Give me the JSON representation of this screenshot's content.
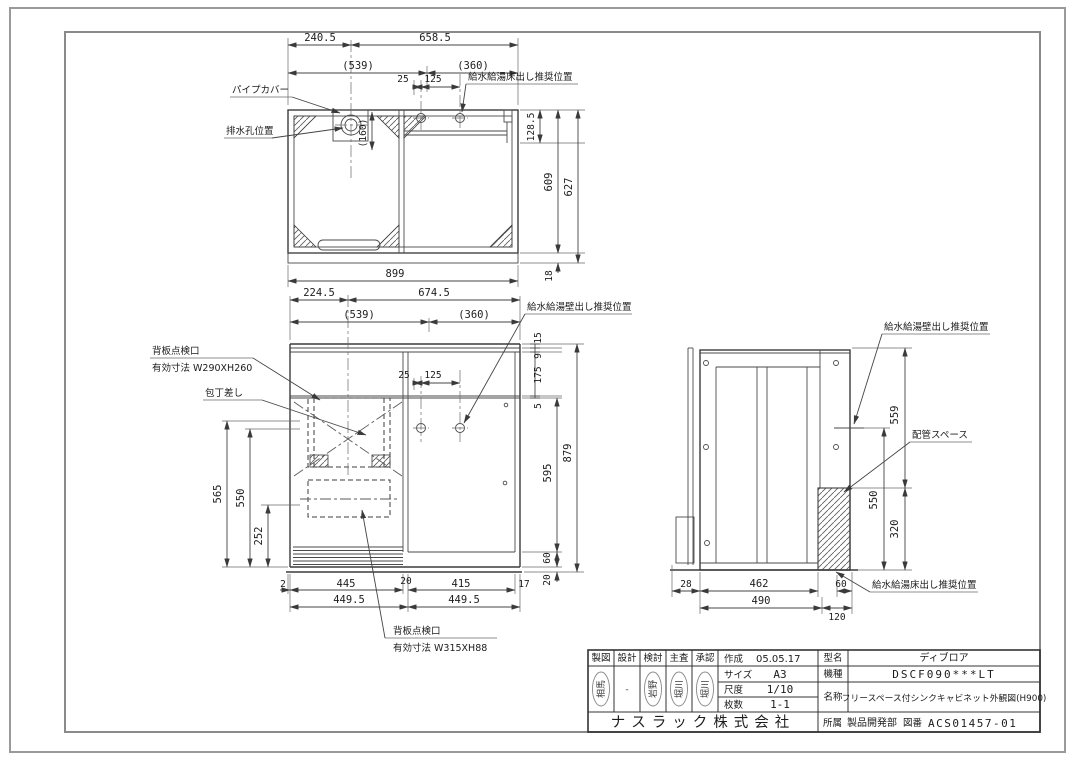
{
  "top_view": {
    "dims": {
      "w240_5": "240.5",
      "w658_5": "658.5",
      "w539": "(539)",
      "w360": "(360)",
      "d25": "25",
      "d125": "125",
      "d160": "(160)",
      "h128_5": "128.5",
      "h609": "609",
      "h627": "627",
      "h18": "18",
      "w899": "899"
    },
    "labels": {
      "pipe_cover": "パイプカバー",
      "drain": "排水孔位置",
      "floor_supply": "給水給湯床出し推奨位置"
    }
  },
  "front_view": {
    "dims": {
      "w224_5": "224.5",
      "w674_5": "674.5",
      "w539": "(539)",
      "w360": "(360)",
      "d25": "25",
      "d125": "125",
      "h15": "15",
      "h9": "9",
      "h175": "175",
      "h5": "5",
      "h595": "595",
      "h60": "60",
      "h20": "20",
      "h879": "879",
      "l565": "565",
      "l550": "550",
      "l252": "252",
      "b2": "2",
      "b445": "445",
      "b20": "20",
      "b415": "415",
      "b17": "17",
      "b449_5a": "449.5",
      "b449_5b": "449.5"
    },
    "labels": {
      "wall_supply": "給水給湯壁出し推奨位置",
      "inspect_upper_line1": "背板点検口",
      "inspect_upper_line2": "有効寸法 W290XH260",
      "knife": "包丁差し",
      "inspect_lower_line1": "背板点検口",
      "inspect_lower_line2": "有効寸法 W315XH88"
    }
  },
  "side_view": {
    "dims": {
      "h559": "559",
      "h550": "550",
      "h320": "320",
      "b28": "28",
      "b462": "462",
      "b60": "60",
      "b490": "490",
      "b120": "120"
    },
    "labels": {
      "wall_supply": "給水給湯壁出し推奨位置",
      "pipe_space": "配管スペース",
      "floor_supply": "給水給湯床出し推奨位置"
    }
  },
  "title_block": {
    "headers": [
      "製図",
      "設計",
      "検討",
      "主査",
      "承認"
    ],
    "stamps": [
      "相馬",
      "-",
      "岩野",
      "堀川",
      "堀川"
    ],
    "created_label": "作成",
    "created": "05.05.17",
    "size_label": "サイズ",
    "size": "A3",
    "scale_label": "尺度",
    "scale": "1/10",
    "sheets_label": "枚数",
    "sheets": "1-1",
    "model_label": "型名",
    "model": "ディブロア",
    "type_label": "機種",
    "type": "DSCF090***LT",
    "name_label": "名称",
    "name": "フリースペース付シンクキャビネット外観図(H900)",
    "company": "ナスラック株式会社",
    "dept_label": "所属",
    "dept": "製品開発部",
    "dwg_no_label": "図番",
    "dwg_no": "ACS01457-01"
  }
}
